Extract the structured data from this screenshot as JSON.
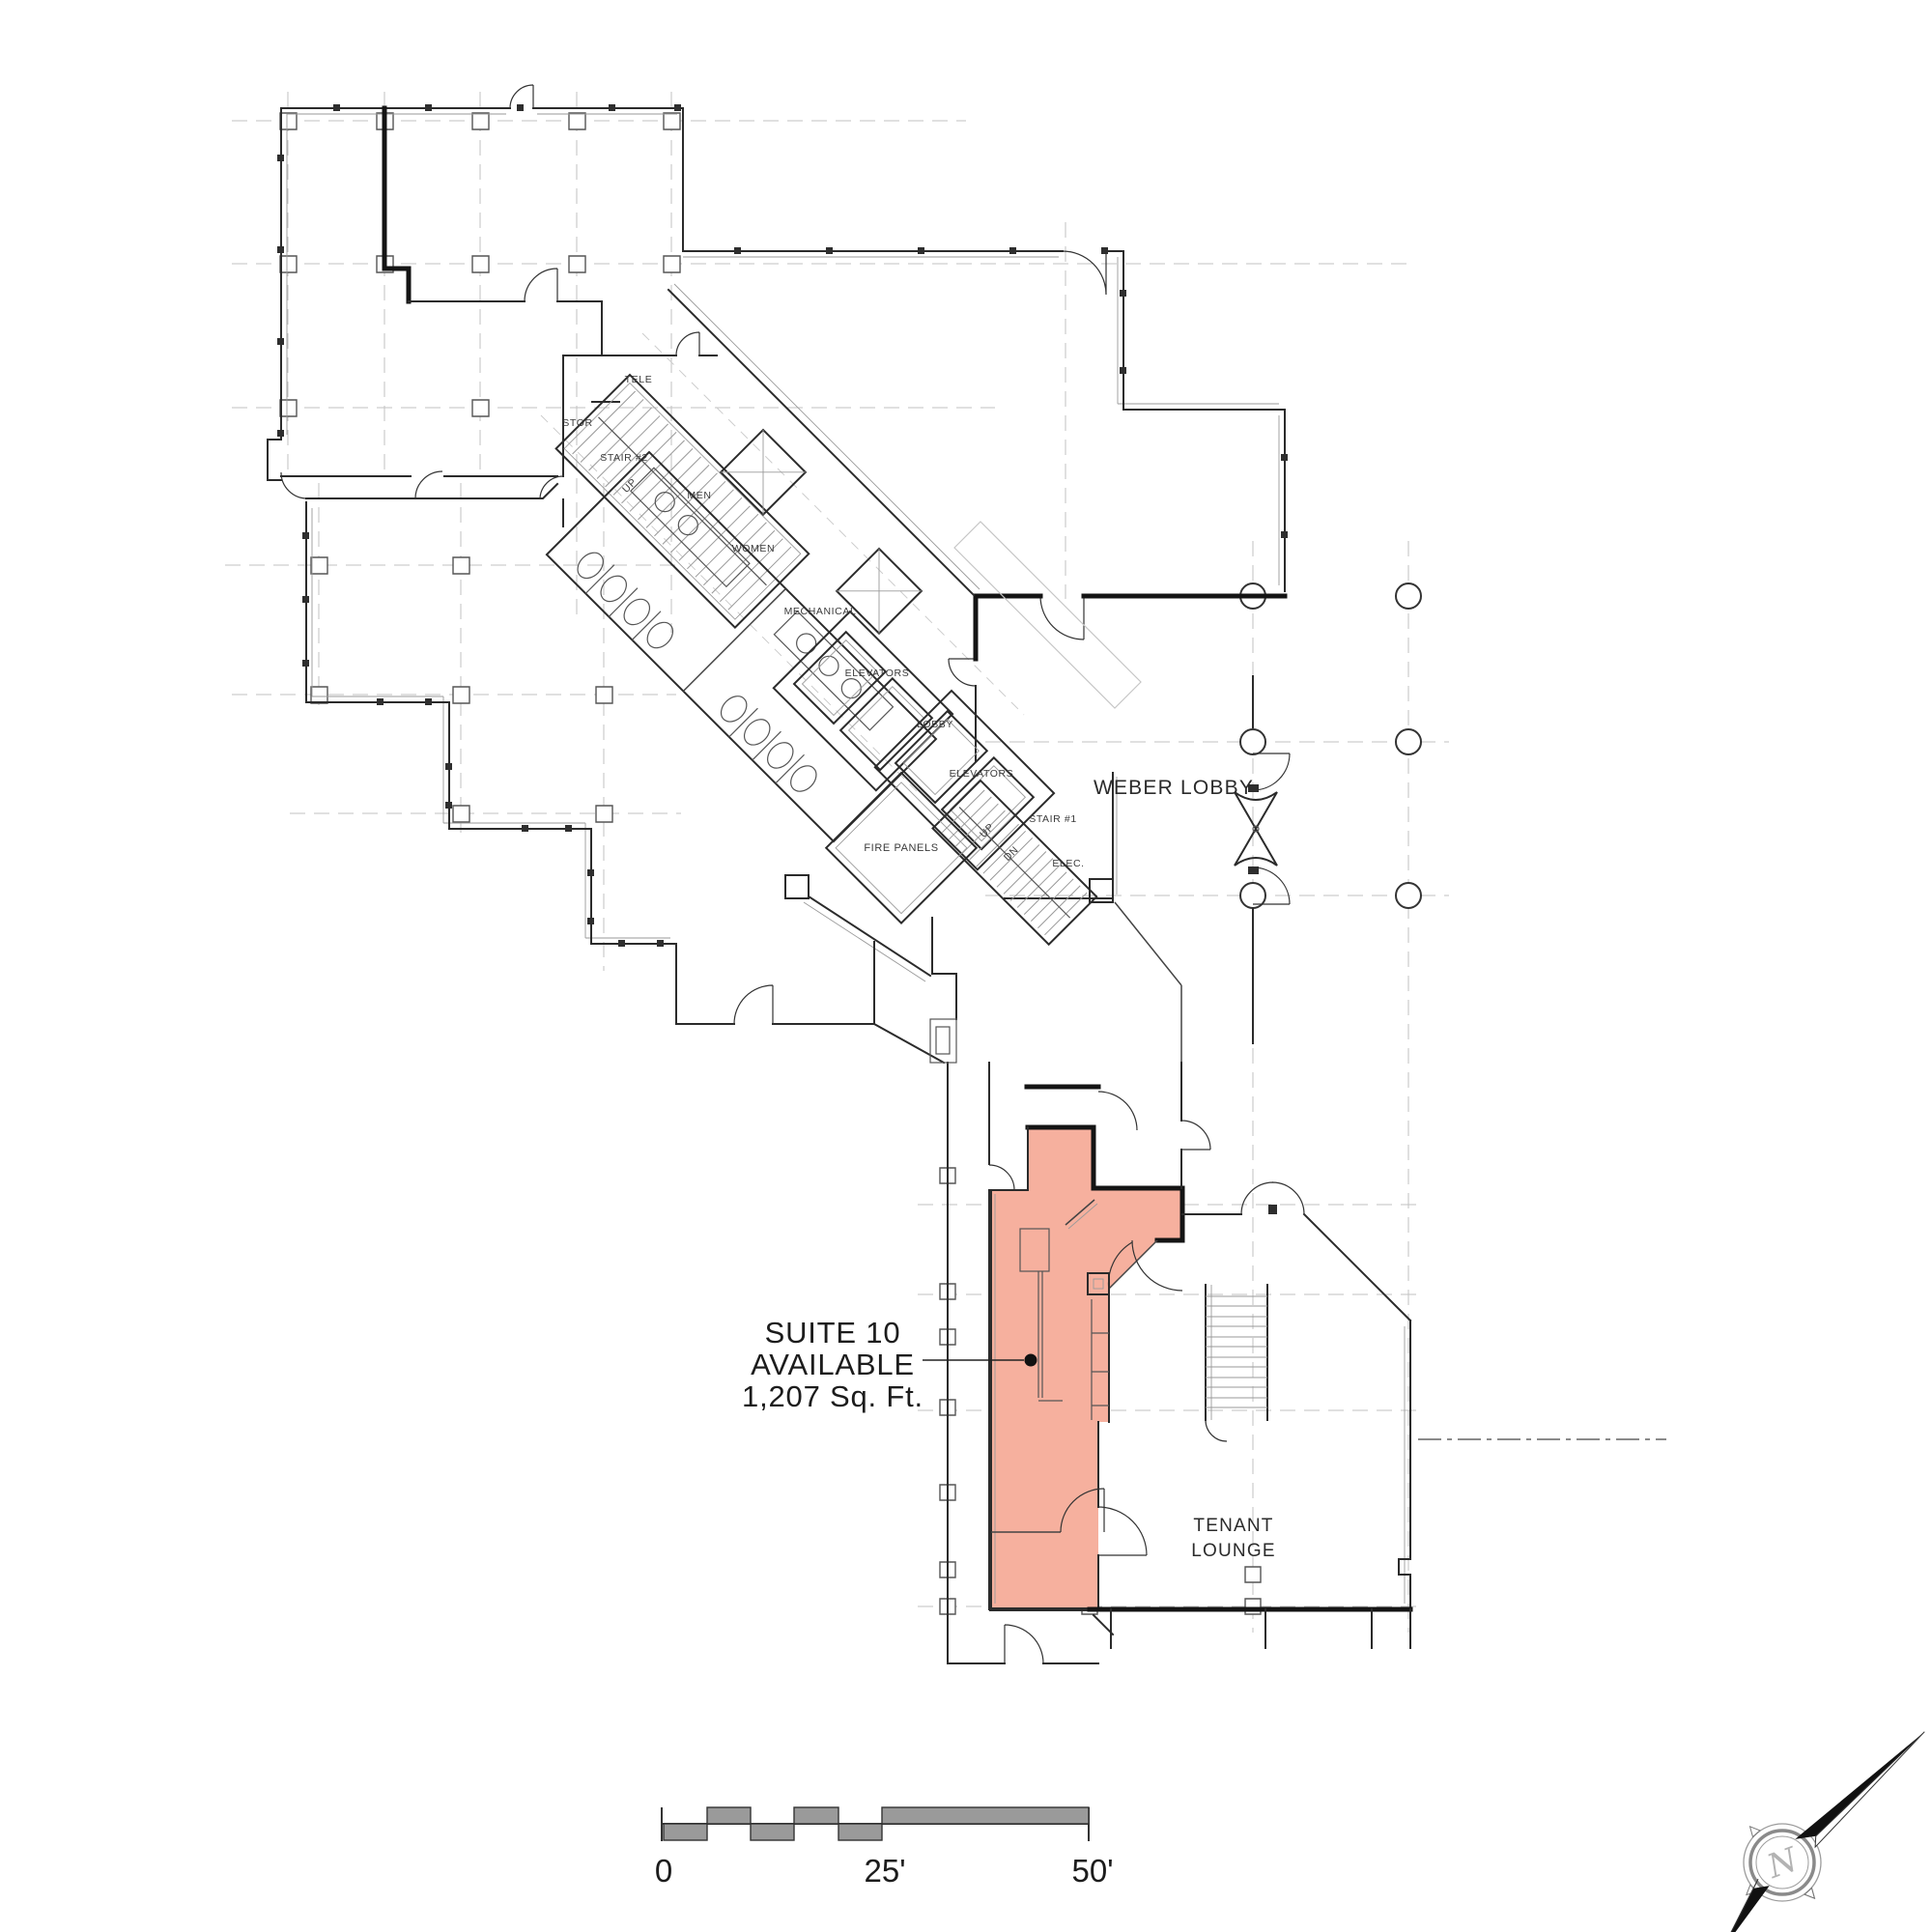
{
  "plan": {
    "rooms": {
      "tele": "TELE",
      "stor": "STOR",
      "stair2": "STAIR #2",
      "up": "UP",
      "men": "MEN",
      "women": "WOMEN",
      "mechanical": "MECHANICAL",
      "elevators": "ELEVATORS",
      "lobby": "LOBBY",
      "stair1": "STAIR #1",
      "dn": "DN",
      "fire_panels": "FIRE PANELS",
      "elec": "ELEC."
    },
    "areas": {
      "weber_lobby": "WEBER LOBBY",
      "tenant_lounge_line1": "TENANT",
      "tenant_lounge_line2": "LOUNGE"
    },
    "suite_callout": {
      "line1": "SUITE 10",
      "line2": "AVAILABLE",
      "line3": "1,207 Sq. Ft."
    },
    "colors": {
      "highlight": "#F6B09E",
      "walls": "#2b2b2b",
      "scale_gray": "#9a9a9a"
    }
  },
  "scale_bar": {
    "tick0": "0",
    "tick25": "25'",
    "tick50": "50'"
  },
  "compass": {
    "letter": "N"
  }
}
